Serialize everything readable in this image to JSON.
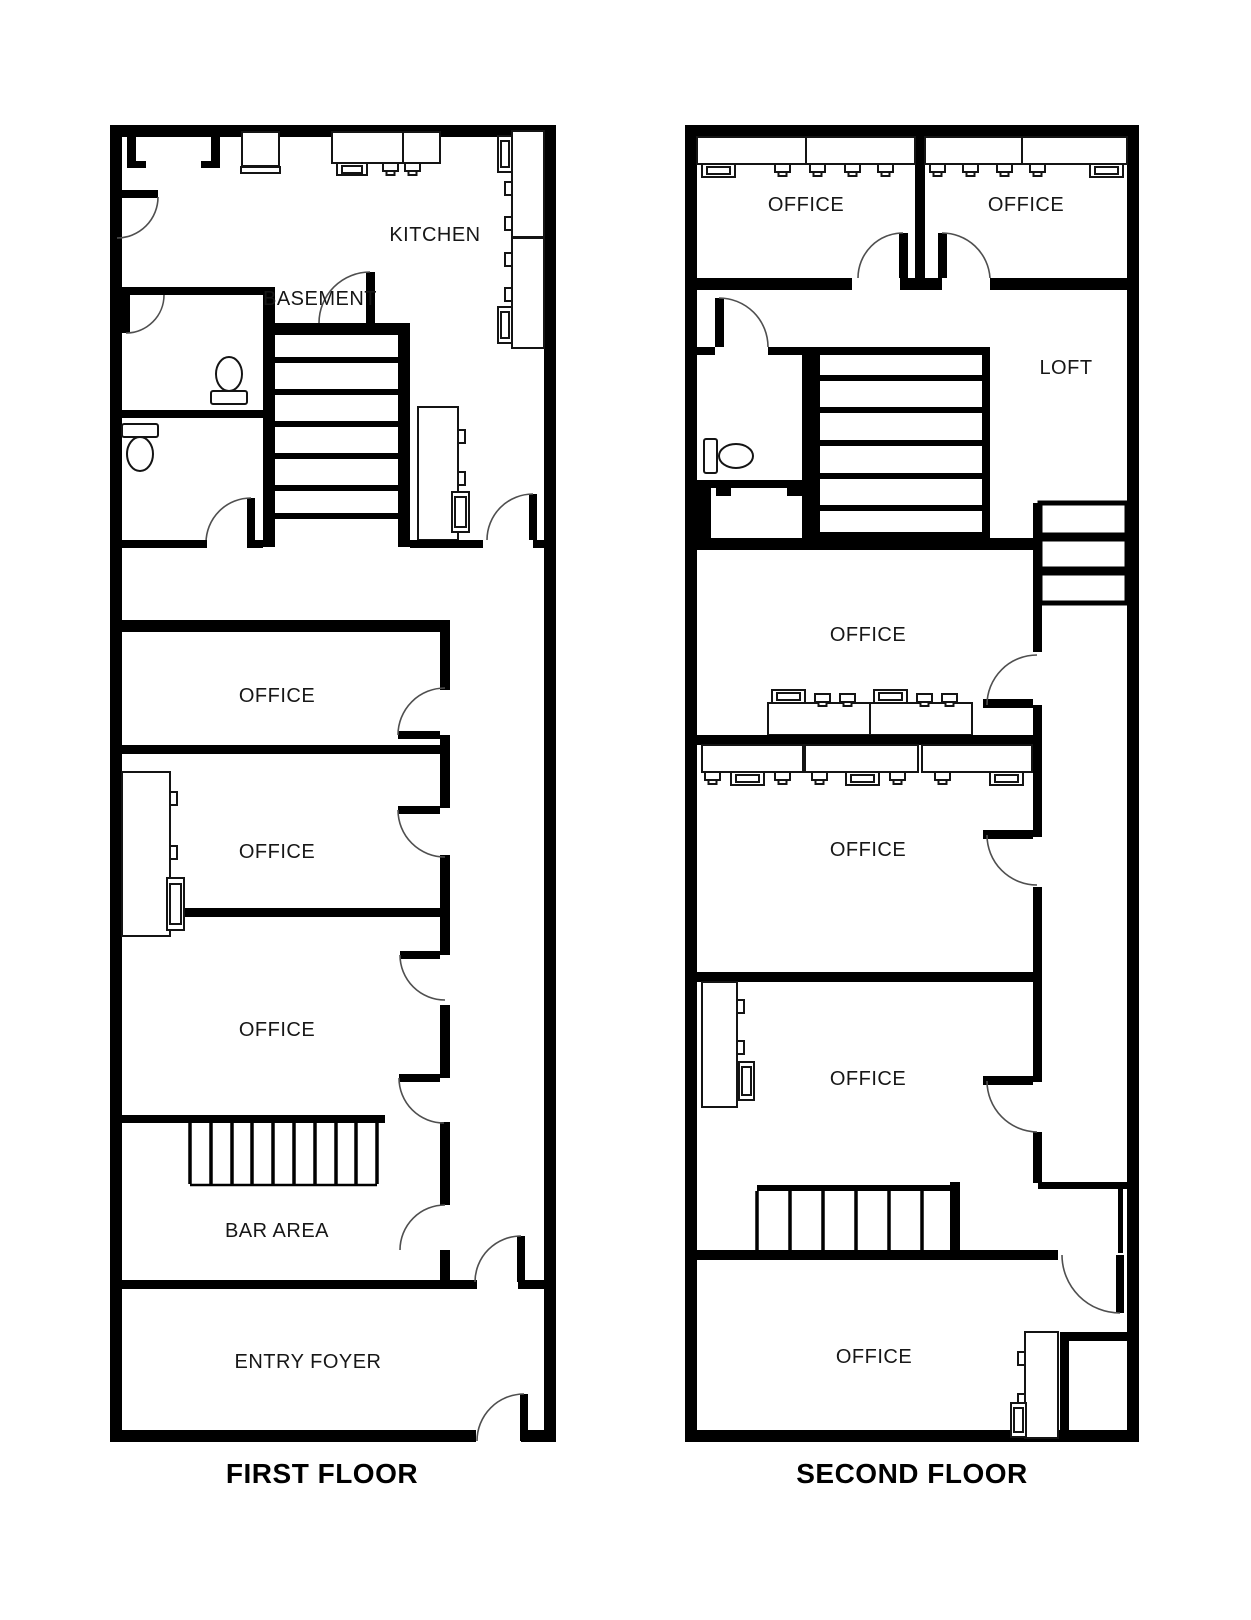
{
  "page": {
    "background": "#ffffff"
  },
  "colors": {
    "page_bg": "#ffffff",
    "wall": "#000000",
    "door_arc": "#4f4f4f",
    "fixture_stroke": "#141414",
    "text": "#171717"
  },
  "floors": [
    {
      "label": "FIRST FLOOR",
      "rooms": [
        {
          "name": "kitchen",
          "label": "KITCHEN"
        },
        {
          "name": "basement-stairwell",
          "label": "BASEMENT"
        },
        {
          "name": "office-upper",
          "label": "OFFICE"
        },
        {
          "name": "office-middle",
          "label": "OFFICE"
        },
        {
          "name": "office-lower",
          "label": "OFFICE"
        },
        {
          "name": "bar-area",
          "label": "BAR AREA"
        },
        {
          "name": "entry-foyer",
          "label": "ENTRY FOYER"
        }
      ],
      "fixtures": [
        "fireplace-niche",
        "appliance",
        "kitchen-counter",
        "wall-cabinets-with-sinks",
        "kitchen-island",
        "toilet",
        "toilet",
        "basement-staircase",
        "staircase-up",
        "office-cabinet",
        "swing-doors"
      ]
    },
    {
      "label": "SECOND FLOOR",
      "rooms": [
        {
          "name": "office-northwest",
          "label": "OFFICE"
        },
        {
          "name": "office-northeast",
          "label": "OFFICE"
        },
        {
          "name": "loft",
          "label": "LOFT"
        },
        {
          "name": "office-upper-middle",
          "label": "OFFICE"
        },
        {
          "name": "office-middle",
          "label": "OFFICE"
        },
        {
          "name": "office-lower-middle",
          "label": "OFFICE"
        },
        {
          "name": "office-south",
          "label": "OFFICE"
        }
      ],
      "fixtures": [
        "desk-workstations",
        "toilet",
        "closet",
        "staircase-from-first-floor",
        "storage-shelves",
        "office-cabinet",
        "staircase-down",
        "corner-closet",
        "swing-doors"
      ]
    }
  ]
}
